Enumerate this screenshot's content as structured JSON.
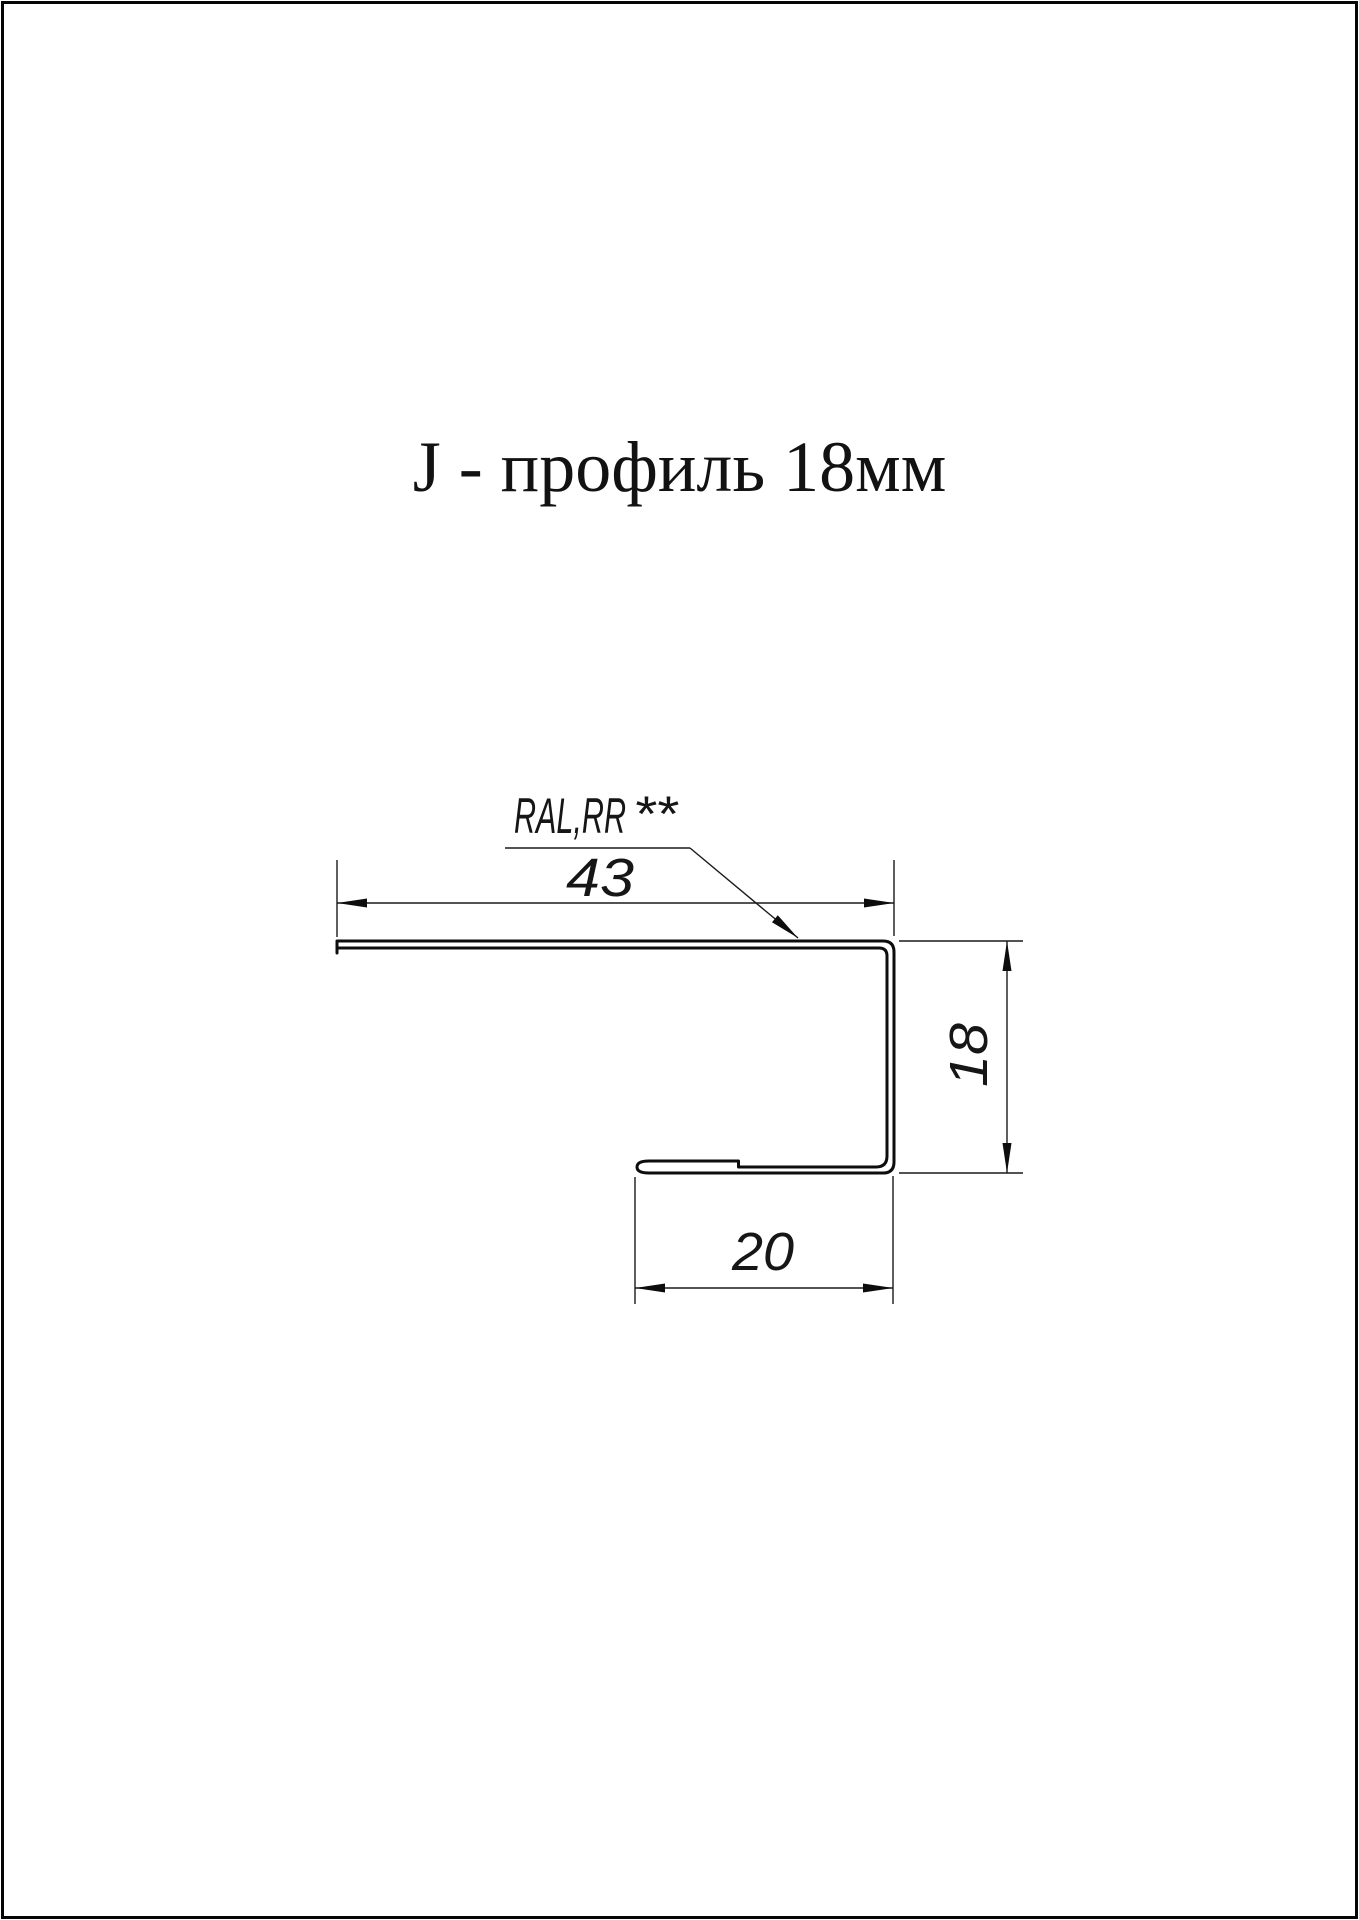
{
  "title": "J - профиль 18мм",
  "drawing": {
    "callout": {
      "label": "RAL,RR",
      "suffix": "**"
    },
    "dims": {
      "top_width": "43",
      "right_height": "18",
      "bottom_lip": "20"
    }
  },
  "colors": {
    "background": "#ffffff",
    "line": "#0d0d0d"
  }
}
